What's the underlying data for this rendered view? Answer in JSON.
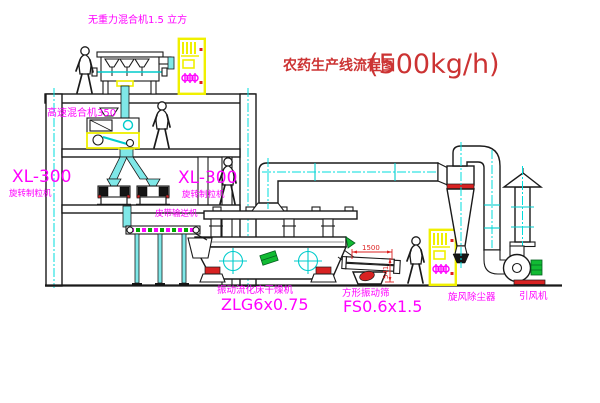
{
  "title": {
    "text": "农药生产线流程图",
    "capacity": "(500kg/h)"
  },
  "labels": {
    "gravity_mixer": "无重力混合机1.5 立方",
    "high_speed_mixer": "高速混合机350",
    "granulator_model_left": "XL-300",
    "granulator_name_left": "旋转制粒机",
    "granulator_model_right": "XL-300",
    "granulator_name_right": "旋转制粒机",
    "belt_conveyor": "皮带输送机",
    "dryer_name": "振动流化床干燥机",
    "dryer_model": "ZLG6x0.75",
    "screen_name": "方形振动筛",
    "screen_model": "FS0.6x1.5",
    "cyclone": "旋风除尘器",
    "fan": "引风机"
  },
  "dimensions": {
    "screen_length": "1500",
    "screen_height": "541"
  },
  "colors": {
    "label_magenta": "#ff00ff",
    "title_red": "#cc3333",
    "dimension_red": "#dd2222",
    "centerline_cyan": "#00dddd",
    "cabinet_yellow": "#f0f000",
    "pipe_cyan": "#7fe8e8",
    "accent_green": "#11bb33",
    "cyclone_band_red": "#cc2222"
  }
}
